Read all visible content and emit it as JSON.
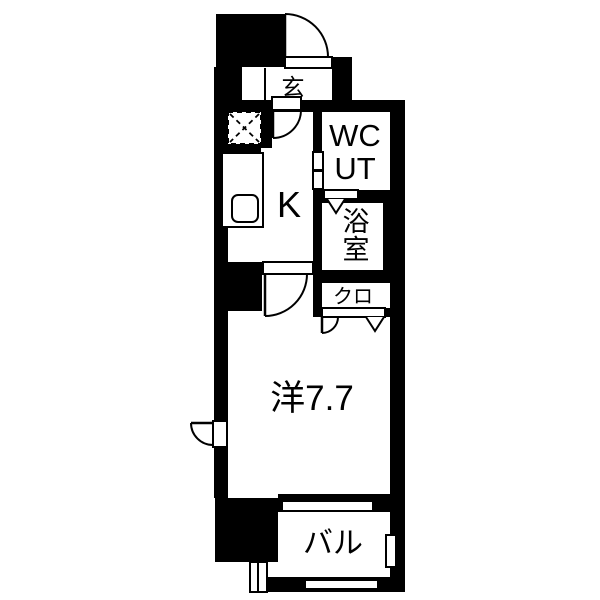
{
  "meta": {
    "type": "apartment-floor-plan",
    "style": "black-and-white 1K madori diagram"
  },
  "colors": {
    "wall": "#000000",
    "floor": "#ffffff",
    "line": "#000000"
  },
  "rooms": {
    "genkan": {
      "label": "玄"
    },
    "wc_ut": {
      "label_line1": "WC",
      "label_line2": "UT"
    },
    "bathroom": {
      "label_char1": "浴",
      "label_char2": "室"
    },
    "closet": {
      "label": "クロ"
    },
    "kitchen": {
      "label": "K"
    },
    "main_room": {
      "label": "洋7.7",
      "size_tatami": "7.7"
    },
    "balcony": {
      "label": "バル"
    }
  }
}
